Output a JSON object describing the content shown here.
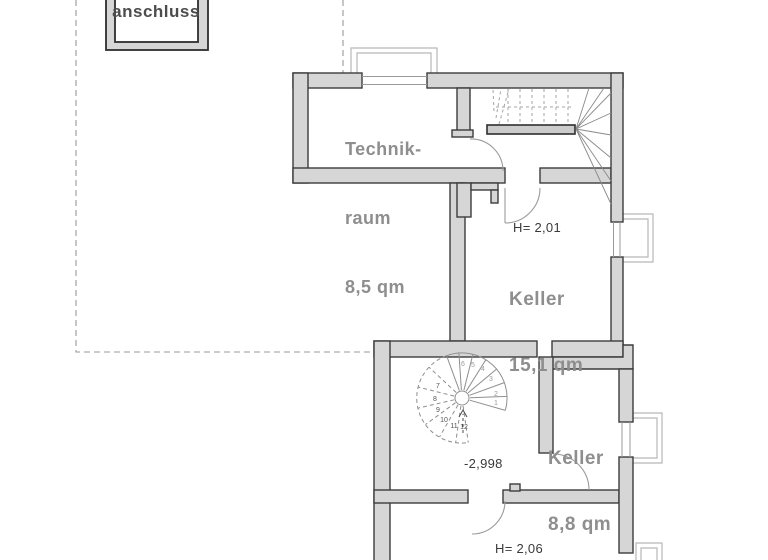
{
  "plan": {
    "title": "basement floor plan",
    "connection_box": {
      "label": "anschluss"
    },
    "rooms": {
      "technikraum": {
        "name_line1": "Technik-",
        "name_line2": "raum",
        "area": "8,5 qm"
      },
      "keller_main": {
        "name": "Keller",
        "area": "15,1 qm",
        "height_note": "H= 2,01"
      },
      "keller_small": {
        "name": "Keller",
        "area": "8,8 qm"
      },
      "lower_room": {
        "height_note": "H= 2,06"
      }
    },
    "level_marker": "-2,998",
    "spiral_staircase": {
      "steps": [
        "1",
        "2",
        "3",
        "4",
        "5",
        "6",
        "7",
        "8",
        "9",
        "10",
        "11",
        "12"
      ]
    },
    "colors": {
      "wall_fill": "#d6d6d6",
      "wall_stroke": "#3c3c3c",
      "room_label": "#8e8e8e",
      "annotation": "#3a3a3a",
      "light_well": "#b8b8b8",
      "dashed_outline": "#999999",
      "background": "#ffffff"
    }
  }
}
